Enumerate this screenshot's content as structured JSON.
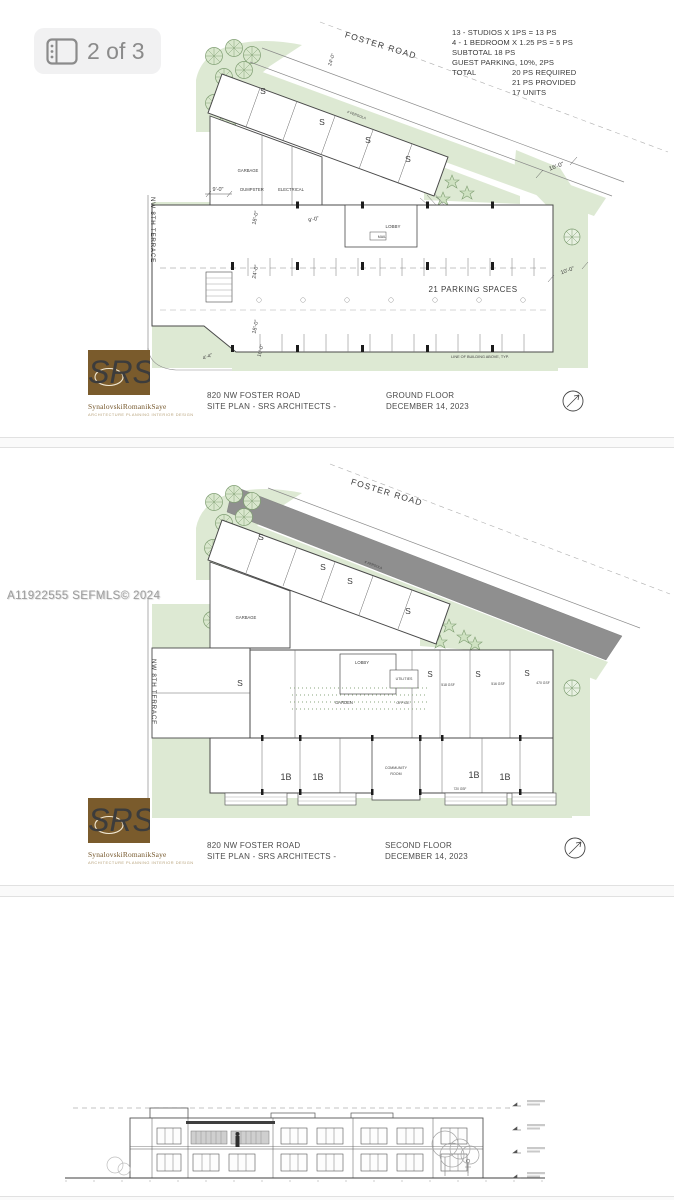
{
  "ui": {
    "photo_badge": {
      "label": "2 of 3",
      "icon": "gallery-icon"
    },
    "watermark": "A11922555 SEFMLS© 2024"
  },
  "branding": {
    "monogram": "SRS",
    "firm_name": "SynalovskiRomanikSaye",
    "tagline": "ARCHITECTURE PLANNING INTERIOR DESIGN",
    "brand_color": "#7a5b2c"
  },
  "ground_floor_plan": {
    "streets": {
      "top": "FOSTER ROAD",
      "left": "NW 8TH TERRACE"
    },
    "parking_summary": {
      "lines": [
        "13 - STUDIOS X 1PS = 13 PS",
        "4 - 1 BEDROOM X 1.25 PS = 5 PS",
        "SUBTOTAL 18 PS",
        "GUEST PARKING, 10%, 2PS"
      ],
      "total_label": "TOTAL",
      "total_lines": [
        "20 PS REQUIRED",
        "21 PS PROVIDED",
        "17 UNITS"
      ]
    },
    "labels": {
      "studio": "S",
      "garbage": "GARBAGE",
      "dumpster": "DUMPSTER",
      "electrical": "ELECTRICAL",
      "lobby": "LOBBY",
      "mail": "MAIL",
      "pergola": "4' PERGOLA",
      "parking_spaces": "21 PARKING SPACES",
      "building_above_note": "LINE OF BUILDING ABOVE, TYP."
    },
    "dimensions": {
      "d9a": "9'-0\"",
      "d9b": "9'-0\"",
      "d18a": "18'-0\"",
      "d18b": "18'-0\"",
      "d24a": "24'-0\"",
      "d24b": "24'-0\"",
      "d10a": "10'-0\"",
      "d10b": "10'-0\"",
      "d16": "16'-0\"",
      "d4": "4'-4\""
    },
    "title_block": {
      "address": "820 NW FOSTER ROAD",
      "plan_line": "SITE PLAN - SRS ARCHITECTS  -",
      "floor": "GROUND FLOOR",
      "date": "DECEMBER 14, 2023"
    }
  },
  "second_floor_plan": {
    "streets": {
      "top": "FOSTER ROAD",
      "left": "NW 8TH TERRACE"
    },
    "labels": {
      "studio": "S",
      "one_bed": "1B",
      "garbage": "GARBAGE",
      "lobby": "LOBBY",
      "garden": "GARDEN",
      "utilities": "UTILITIES",
      "office": "OFFICE",
      "community_line1": "COMMUNITY",
      "community_line2": "ROOM",
      "pergola": "4' PERGOLA"
    },
    "areas": {
      "gsf_a": "518 GSF",
      "gsf_b": "516 GSF",
      "gsf_c": "470 GSF",
      "gsf_d": "720 GSF"
    },
    "title_block": {
      "address": "820 NW FOSTER ROAD",
      "plan_line": "SITE PLAN - SRS ARCHITECTS  -",
      "floor": "SECOND FLOOR",
      "date": "DECEMBER 14, 2023"
    }
  }
}
